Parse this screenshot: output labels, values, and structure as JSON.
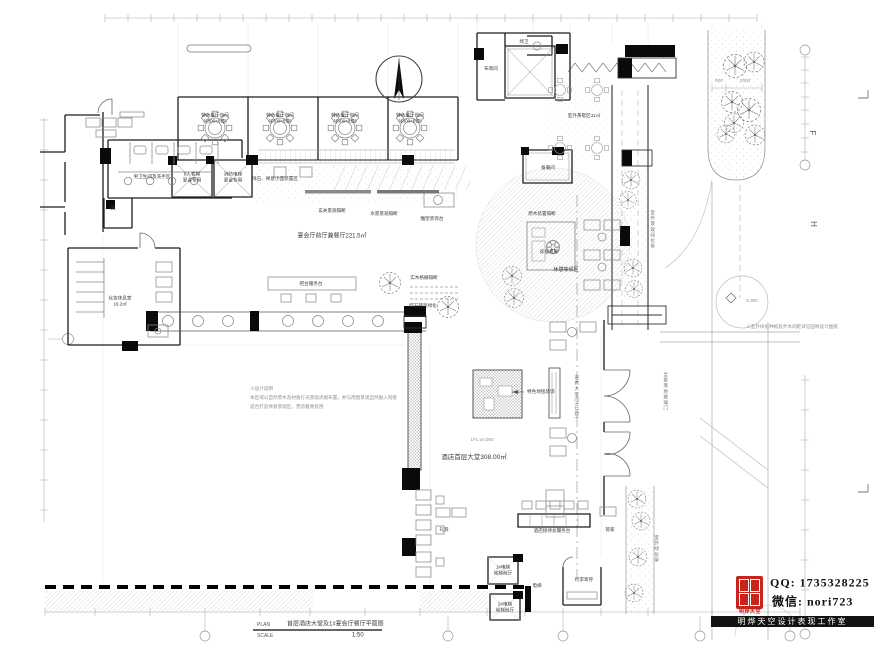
{
  "title_block": {
    "plan_label": "PLAN",
    "drawing_title": "首层酒店大堂及1#宴会厅餐厅平面图",
    "scale_label": "SCALE",
    "scale_value": "1:50"
  },
  "watermark": {
    "qq": "QQ: 1735328225",
    "wechat": "微信: nori723",
    "seal_caption": "明烨天空",
    "studio_bar": "明烨天空设计表现工作室"
  },
  "colors": {
    "seal_red": "#c8241c",
    "wall_black": "#1c1c1c",
    "hatch_gray": "#c9c9c9",
    "dim_gray": "#9a9a9a"
  },
  "icons": {
    "north_arrow": "compass-needle",
    "seal": "red-seal-stamp",
    "tree": "tree-plan-symbol"
  },
  "labels": {
    "dining_name": "特色餐厅包间",
    "dining_size": "(1300×8位)",
    "mens_wc": "男卫生间及洗手区",
    "air_room": "风",
    "lift1_l1": "8人客梯",
    "lift1_l2": "宴会专用",
    "lift2_l1": "消防电梯",
    "lift2_l2": "宴会专用",
    "terrace_note": "绿石、禅意小品装置区",
    "entry_screen": "玄关景观隔断",
    "water_screen": "水景景观隔断",
    "sculpture": "雕塑装饰台",
    "foyer": "宴会厅前厅兼餐厅221.5㎡",
    "makeup_l1": "化妆休息室",
    "makeup_l2": "16.2㎡",
    "bar": "吧台服务台",
    "wood_grille": "实木格栅隔断",
    "gravel": "碎石铺装绿化",
    "center_screen": "原木装置隔断",
    "center_view": "穿插景观",
    "lounge": "休憩等候区",
    "lobby": "酒店首层大堂308.00㎡",
    "level": "1FL ±0.000",
    "carpet": "特色地毯装饰",
    "door_v": "迎宾大堂门(已建)",
    "glass_v": "全景落地玻璃门",
    "greenbelt_v": "室外景观绿化带",
    "greenbelt2_v": "室外绿化带",
    "reception": "酒店接待总服务台",
    "concierge": "礼宾",
    "butler": "管家",
    "lobby1_l1": "1#电梯",
    "lobby1_l2": "候梯前厅",
    "lobby2_l1": "2#电梯",
    "lobby2_l2": "候梯前厅",
    "elevator": "电梯",
    "luggage": "行李寄存",
    "linen": "布草间",
    "hc_wc": "残卫",
    "pantry": "备餐间",
    "outdoor": "室外茶歇区31㎡"
  },
  "notes": {
    "title": "※设计说明",
    "line1": "本区域以自然原木及材质灯光景观点缀布置，并与周围景观自然融入衔接",
    "line2": "适合打造禅意景观区，营造雅致氛围",
    "road": "※室外绿化种植及乔木间距详见园林设计图纸"
  },
  "dims": {
    "strip_w": "900",
    "strip_l": "2000",
    "road_level": "6.300",
    "grid_f": "F",
    "grid_h": "H"
  }
}
